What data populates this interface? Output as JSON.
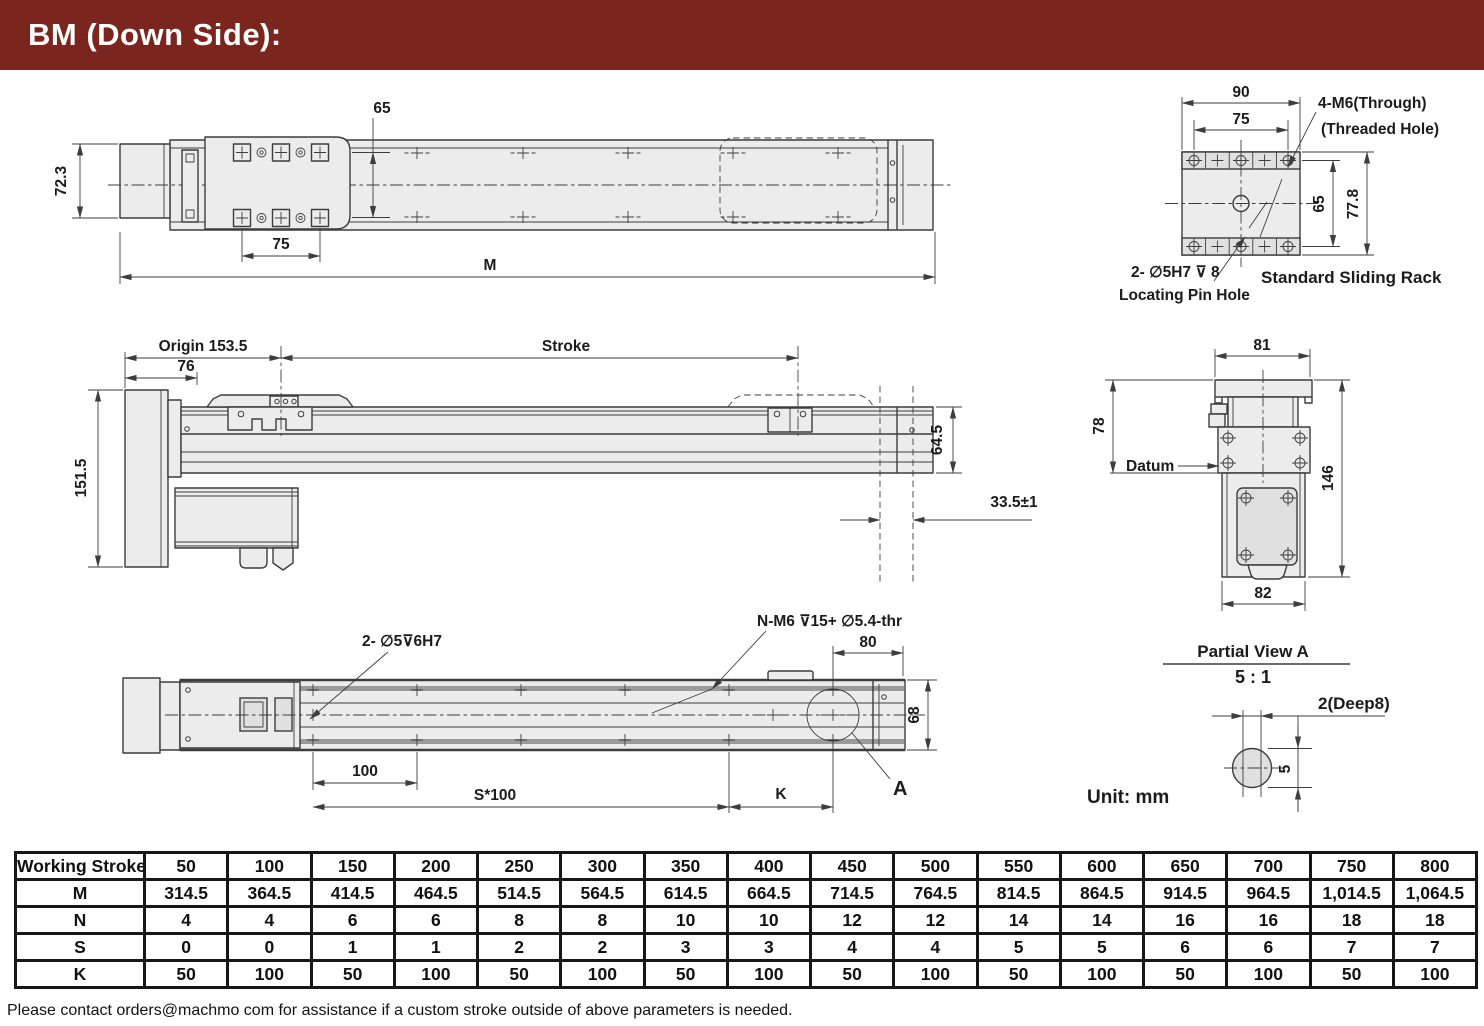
{
  "header": {
    "title": "BM (Down Side):"
  },
  "unit_label": "Unit: mm",
  "top_view": {
    "dim_carriage_rows": "65",
    "dim_carriage_length": "75",
    "dim_body_height": "72.3",
    "dim_total_length": "M"
  },
  "side_view": {
    "origin_label": "Origin 153.5",
    "dim_left_offset": "76",
    "stroke_label": "Stroke",
    "dim_overall_height": "151.5",
    "dim_rail_height": "64.5",
    "dim_end_clearance": "33.5±1"
  },
  "bottom_view": {
    "pin_hole_label": "2- ∅5⊽6H7",
    "thread_label": "N-M6  ⊽15+ ∅5.4-thr",
    "dim_end_offset": "80",
    "dim_rail_width": "68",
    "dim_hole_pitch": "100",
    "dim_hole_span": "S*100",
    "dim_k": "K",
    "detail_callout": "A"
  },
  "rack_view": {
    "dim_outer_width": "90",
    "dim_hole_spacing": "75",
    "dim_hole_rows": "65",
    "dim_height": "77.8",
    "through_label_1": "4-M6(Through)",
    "through_label_2": "(Threaded Hole)",
    "pin_label_1": "2- ∅5H7 ⊽ 8",
    "pin_label_2": "Locating Pin Hole",
    "caption": "Standard Sliding Rack"
  },
  "end_view": {
    "dim_top_width": "81",
    "dim_upper_height": "78",
    "datum_label": "Datum",
    "dim_total_height": "146",
    "dim_bottom_width": "82"
  },
  "partial_view": {
    "title": "Partial View A",
    "scale": "5 : 1",
    "hole_label": "2(Deep8)",
    "dim_width": "5"
  },
  "table": {
    "header_label": "Working Stroke",
    "header_values": [
      "50",
      "100",
      "150",
      "200",
      "250",
      "300",
      "350",
      "400",
      "450",
      "500",
      "550",
      "600",
      "650",
      "700",
      "750",
      "800"
    ],
    "rows": [
      {
        "label": "M",
        "values": [
          "314.5",
          "364.5",
          "414.5",
          "464.5",
          "514.5",
          "564.5",
          "614.5",
          "664.5",
          "714.5",
          "764.5",
          "814.5",
          "864.5",
          "914.5",
          "964.5",
          "1,014.5",
          "1,064.5"
        ]
      },
      {
        "label": "N",
        "values": [
          "4",
          "4",
          "6",
          "6",
          "8",
          "8",
          "10",
          "10",
          "12",
          "12",
          "14",
          "14",
          "16",
          "16",
          "18",
          "18"
        ]
      },
      {
        "label": "S",
        "values": [
          "0",
          "0",
          "1",
          "1",
          "2",
          "2",
          "3",
          "3",
          "4",
          "4",
          "5",
          "5",
          "6",
          "6",
          "7",
          "7"
        ]
      },
      {
        "label": "K",
        "values": [
          "50",
          "100",
          "50",
          "100",
          "50",
          "100",
          "50",
          "100",
          "50",
          "100",
          "50",
          "100",
          "50",
          "100",
          "50",
          "100"
        ]
      }
    ]
  },
  "footer": {
    "note": "Please contact orders@machmo com for assistance if a custom stroke outside of above parameters is needed."
  }
}
